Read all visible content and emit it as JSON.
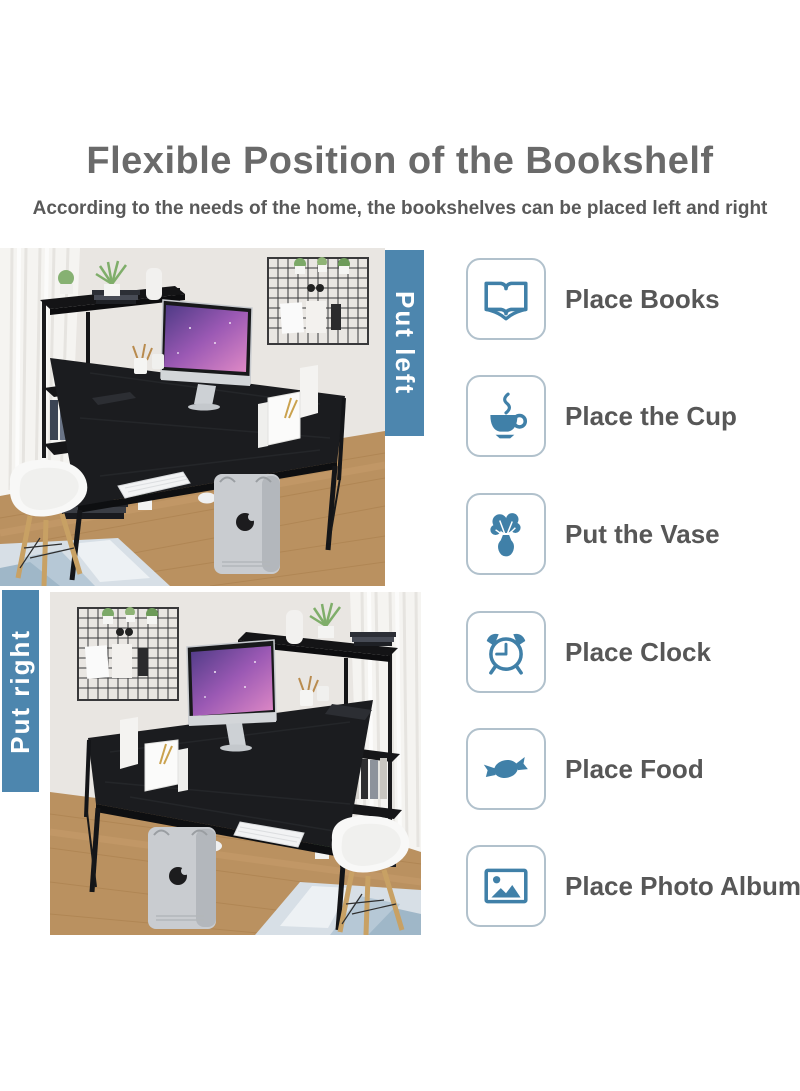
{
  "header": {
    "title": "Flexible Position of the Bookshelf",
    "subtitle": "According to the needs of the home, the bookshelves can be placed left and right"
  },
  "photos": {
    "top": {
      "banner_label": "Put left",
      "description": "Computer desk with the bookshelf placed on the left side"
    },
    "bottom": {
      "banner_label": "Put right",
      "description": "Computer desk with the bookshelf placed on the right side"
    }
  },
  "features": [
    {
      "icon": "open-book-icon",
      "label": "Place Books"
    },
    {
      "icon": "coffee-cup-icon",
      "label": "Place the Cup"
    },
    {
      "icon": "vase-icon",
      "label": "Put the Vase"
    },
    {
      "icon": "alarm-clock-icon",
      "label": "Place Clock"
    },
    {
      "icon": "candy-icon",
      "label": "Place Food"
    },
    {
      "icon": "photo-icon",
      "label": "Place Photo Album"
    }
  ],
  "colors": {
    "banner_blue": "#4d86ae",
    "icon_blue": "#4080a8",
    "icon_box_border": "#b1c1cc",
    "heading_gray": "#6a6a6a",
    "text_gray": "#575757"
  }
}
